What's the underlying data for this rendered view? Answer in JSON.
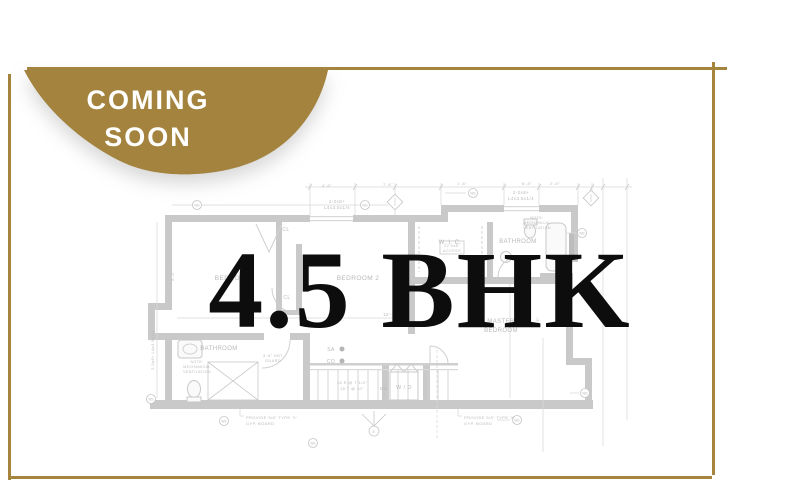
{
  "badge": {
    "line1": "COMING",
    "line2": "SOON"
  },
  "title": "4.5 BHK",
  "colors": {
    "gold": "#a5853e",
    "badge_text": "#ffffff",
    "plan_wall": "#c9c9c9",
    "plan_line": "#d9d9d9",
    "plan_text": "#b9b9b9",
    "title_text": "#0d0d0d"
  },
  "floorplan": {
    "ws_label": "WS",
    "labels": [
      {
        "t": "BEDROOM",
        "x": 233,
        "y": 280,
        "s": 6.5
      },
      {
        "t": "BEDROOM 2",
        "x": 358,
        "y": 280,
        "s": 6.5
      },
      {
        "t": "W. I. C.",
        "x": 450,
        "y": 244,
        "s": 6
      },
      {
        "t": "BATHROOM",
        "x": 518,
        "y": 243,
        "s": 6
      },
      {
        "t": "MASTER",
        "x": 501,
        "y": 323,
        "s": 6
      },
      {
        "t": "BEDROOM",
        "x": 501,
        "y": 332,
        "s": 6
      },
      {
        "t": "BATHROOM",
        "x": 219,
        "y": 350,
        "s": 6
      },
      {
        "t": "W / D",
        "x": 404,
        "y": 389,
        "s": 5.5
      },
      {
        "t": "CL",
        "x": 286,
        "y": 231,
        "s": 5
      },
      {
        "t": "CL",
        "x": 287,
        "y": 299,
        "s": 5
      },
      {
        "t": "2-2x8+",
        "x": 337,
        "y": 203,
        "s": 4.5
      },
      {
        "t": "L4x3.5x1/4",
        "x": 337,
        "y": 209,
        "s": 4.5
      },
      {
        "t": "2-2x8+",
        "x": 521,
        "y": 194,
        "s": 4.5
      },
      {
        "t": "L4x3.5x1/4",
        "x": 521,
        "y": 200,
        "s": 4.5
      },
      {
        "t": "2-2x10",
        "x": 597,
        "y": 301,
        "s": 4.5,
        "r": -90
      },
      {
        "t": "2-3x8+ L4x3.5x1/4",
        "x": 154,
        "y": 350,
        "s": 4,
        "r": -90
      },
      {
        "t": "SA",
        "x": 331,
        "y": 351,
        "s": 5
      },
      {
        "t": "CO",
        "x": 331,
        "y": 363,
        "s": 5
      },
      {
        "t": "PROVIDE 5/8\" TYPE 'X'",
        "x": 246,
        "y": 419,
        "s": 4,
        "a": "start"
      },
      {
        "t": "GYP. BOARD",
        "x": 246,
        "y": 425,
        "s": 4,
        "a": "start"
      },
      {
        "t": "PROVIDE 5/8\" TYPE 'X'",
        "x": 464,
        "y": 419,
        "s": 4,
        "a": "start"
      },
      {
        "t": "GYP. BOARD",
        "x": 464,
        "y": 425,
        "s": 4,
        "a": "start"
      },
      {
        "t": "NOTE:",
        "x": 197,
        "y": 363,
        "s": 3.6
      },
      {
        "t": "MECHANICAL",
        "x": 197,
        "y": 368,
        "s": 3.6
      },
      {
        "t": "VENTILATION",
        "x": 197,
        "y": 373,
        "s": 3.6
      },
      {
        "t": "NOTE:",
        "x": 537,
        "y": 219,
        "s": 3.6
      },
      {
        "t": "MECHANICAL",
        "x": 537,
        "y": 224,
        "s": 3.6
      },
      {
        "t": "VENTILATION",
        "x": 537,
        "y": 229,
        "s": 3.6
      },
      {
        "t": "22\"x48\"",
        "x": 452,
        "y": 247,
        "s": 3.8
      },
      {
        "t": "ACCESS",
        "x": 452,
        "y": 252,
        "s": 3.8
      },
      {
        "t": "16 R @ 7 1/4\"",
        "x": 352,
        "y": 384,
        "s": 4
      },
      {
        "t": "15 T @ 10\"",
        "x": 352,
        "y": 390,
        "s": 4
      },
      {
        "t": "DN",
        "x": 384,
        "y": 390,
        "s": 4.8
      },
      {
        "t": "3'-6\" HGT",
        "x": 273,
        "y": 357,
        "s": 3.8
      },
      {
        "t": "GUARD",
        "x": 273,
        "y": 362,
        "s": 3.8
      },
      {
        "t": "17'-6\"",
        "x": 247,
        "y": 315,
        "s": 4.5
      },
      {
        "t": "12'-6\"",
        "x": 390,
        "y": 316,
        "s": 4.5
      },
      {
        "t": "4'-6\"",
        "x": 327,
        "y": 187,
        "s": 4
      },
      {
        "t": "7'-6\"",
        "x": 388,
        "y": 186,
        "s": 4
      },
      {
        "t": "1'-6\"",
        "x": 462,
        "y": 185,
        "s": 4
      },
      {
        "t": "6'-8\"",
        "x": 527,
        "y": 185,
        "s": 4
      },
      {
        "t": "2'-6\"",
        "x": 555,
        "y": 185,
        "s": 4
      },
      {
        "t": "9'-2\"",
        "x": 174,
        "y": 276,
        "s": 4,
        "r": -90
      },
      {
        "t": "9'-6\"",
        "x": 539,
        "y": 322,
        "s": 4,
        "r": -90
      },
      {
        "t": "E",
        "x": 374,
        "y": 433,
        "s": 3.8
      }
    ],
    "ws_symbols": [
      [
        197,
        205
      ],
      [
        365,
        205
      ],
      [
        473,
        193
      ],
      [
        582,
        233
      ],
      [
        224,
        421
      ],
      [
        517,
        420
      ],
      [
        585,
        393
      ],
      [
        313,
        443
      ],
      [
        151,
        399
      ]
    ],
    "diamond_tags": [
      [
        395,
        202
      ],
      [
        591,
        198
      ]
    ]
  }
}
